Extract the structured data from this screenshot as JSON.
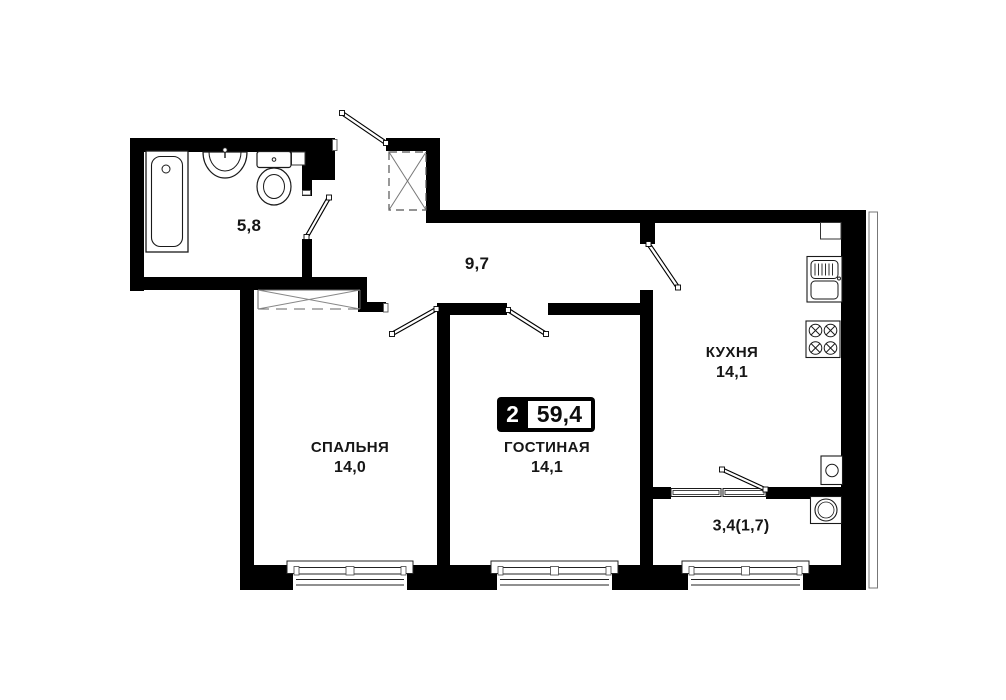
{
  "apartment": {
    "rooms_count": "2",
    "total_area": "59,4"
  },
  "rooms": {
    "bathroom": {
      "area": "5,8"
    },
    "hallway": {
      "area": "9,7"
    },
    "bedroom": {
      "name": "СПАЛЬНЯ",
      "area": "14,0"
    },
    "living_room": {
      "name": "ГОСТИНАЯ",
      "area": "14,1"
    },
    "kitchen": {
      "name": "КУХНЯ",
      "area": "14,1"
    },
    "balcony": {
      "area": "3,4(1,7)"
    }
  },
  "colors": {
    "wall": "#000000",
    "background": "#ffffff",
    "thin_line": "#333333"
  }
}
